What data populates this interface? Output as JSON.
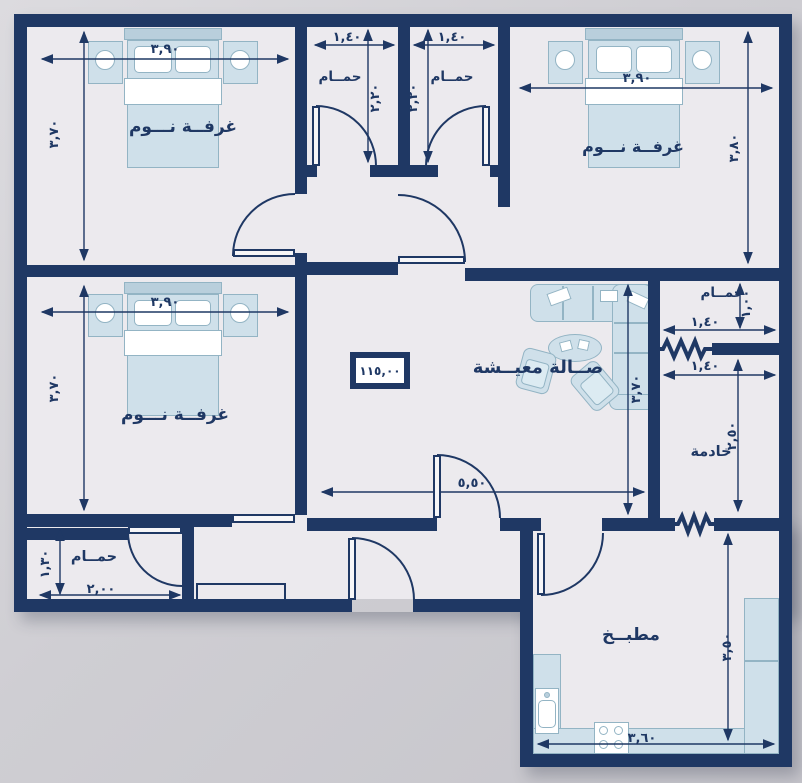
{
  "colors": {
    "wall": "#1f3864",
    "line": "#1f3864",
    "furniture_fill": "#cfe0ea",
    "furniture_border": "#93b4c4",
    "floor": "#eceaee",
    "background": "#cfced3"
  },
  "area_box": {
    "value": "١١٥,٠٠"
  },
  "rooms": {
    "bedroom_tl": {
      "label": "غرفــة نـــوم",
      "dim_w": "٣,٩٠",
      "dim_h": "٣,٧٠"
    },
    "bedroom_tr": {
      "label": "غرفــة نـــوم",
      "dim_w": "٣,٩٠",
      "dim_h": "٣,٨٠"
    },
    "bedroom_ml": {
      "label": "غرفــة نـــوم",
      "dim_w": "٣,٩٠",
      "dim_h": "٣,٧٠"
    },
    "bathroom_top_left": {
      "label": "حمــام",
      "dim_w": "١,٤٠",
      "dim_h": "٢,٢٠"
    },
    "bathroom_top_right": {
      "label": "حمــام",
      "dim_w": "١,٤٠",
      "dim_h": "٢,٢٠"
    },
    "bathroom_right": {
      "label": "حمــام",
      "dim_w": "١,٤٠",
      "dim_h": "١,٠٠"
    },
    "maid_room": {
      "label": "خادمة",
      "dim_w": "١,٤٠",
      "dim_h": "٢,٥٠"
    },
    "living_room": {
      "label": "صــالة معيــشة",
      "dim_w": "٥,٥٠",
      "dim_h": "٣,٧٠"
    },
    "bathroom_bottom_left": {
      "label": "حمــام",
      "dim_w": "٢,٠٠",
      "dim_h": "١,٣٠"
    },
    "kitchen": {
      "label": "مطبــخ",
      "dim_w": "٣,٦٠",
      "dim_h": "٣,٥٠"
    }
  }
}
